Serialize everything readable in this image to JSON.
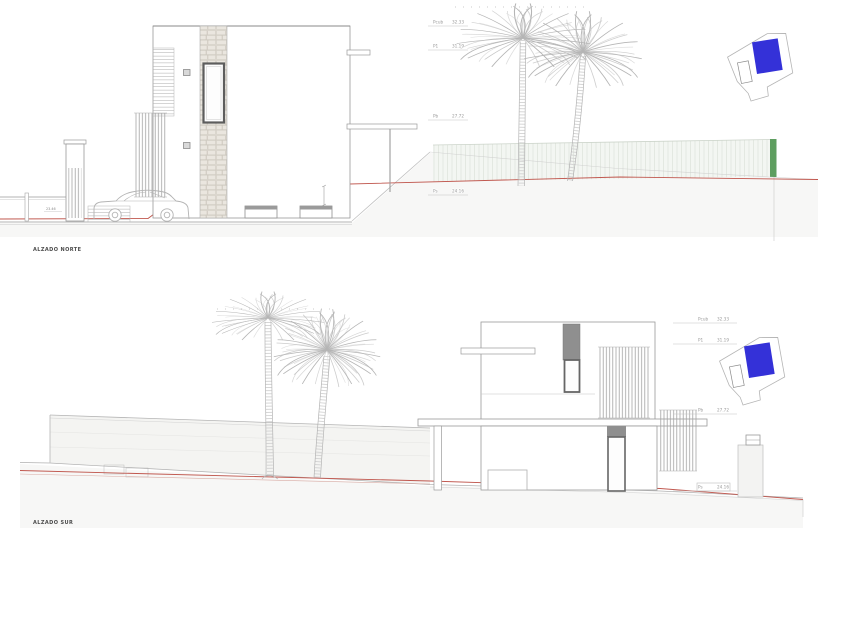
{
  "sheet": {
    "background": "#ffffff"
  },
  "drawings": [
    {
      "title": "ALZADO NORTE",
      "levels": [
        {
          "label": "Pcub",
          "value": "32.33"
        },
        {
          "label": "P1",
          "value": "31.19"
        },
        {
          "label": "Pb",
          "value": "27.72"
        },
        {
          "label": "Ps",
          "value": "24.16"
        }
      ],
      "street_level": "23.46"
    },
    {
      "title": "ALZADO SUR",
      "levels": [
        {
          "label": "Pcub",
          "value": "32.33"
        },
        {
          "label": "P1",
          "value": "31.19"
        },
        {
          "label": "Pb",
          "value": "27.72"
        },
        {
          "label": "Ps",
          "value": "24.16"
        }
      ]
    }
  ],
  "key_plan": {
    "building_color": "#3431d8",
    "pool_outline": "#8a8a8a",
    "plot_outline": "#b5b5b5"
  },
  "colors": {
    "terrain_line": "#c0574e",
    "green_boundary": "#5e9e60",
    "drawing_line": "#9a9a9a",
    "dark_element": "#8f8f8f"
  }
}
